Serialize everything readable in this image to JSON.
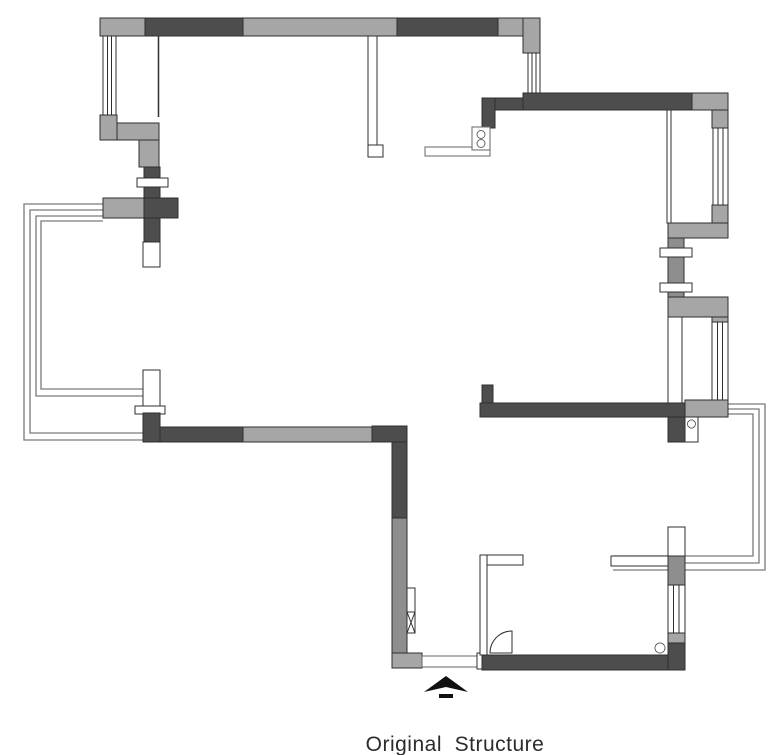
{
  "title": {
    "label": "Original  Structure"
  },
  "colors": {
    "background": "#ffffff",
    "wall_dark": "#4d4d4d",
    "wall_light": "#a6a6a6",
    "wall_mid": "#8e8e8e",
    "outline": "#2f2f2f",
    "railing": "#7a7a7a",
    "fixture_outline": "#666666",
    "text": "#2b2b2b"
  },
  "plan": {
    "type": "floor-plan",
    "drawing_name": "apartment-original-structure",
    "symbols": {
      "entry_arrow": "entry-direction-arrow",
      "stove": "two-burner-stove",
      "door": "quarter-arc-door-swing",
      "windows": "double-line-window-symbol",
      "balconies": "multi-line-railing"
    }
  }
}
